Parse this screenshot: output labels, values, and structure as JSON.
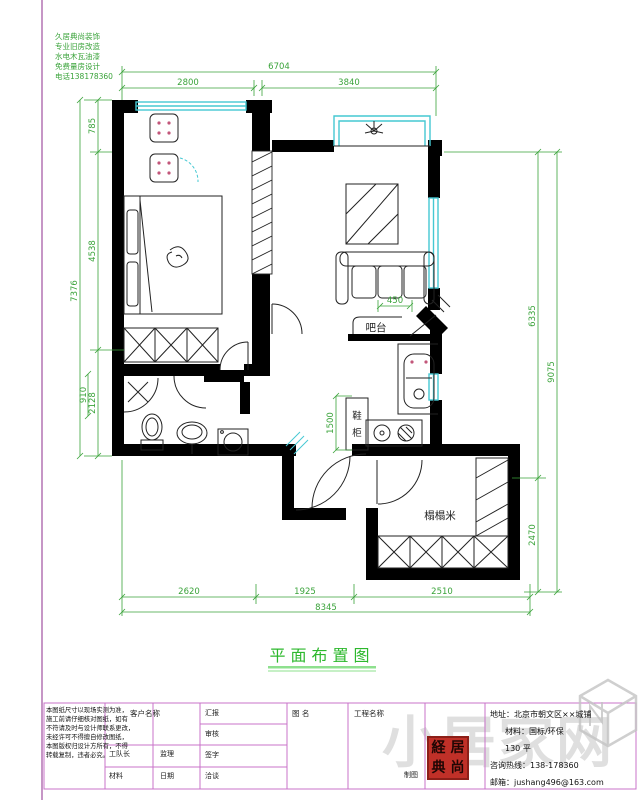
{
  "drawing": {
    "title": "平面布置图",
    "labels": {
      "bar": "吧台",
      "shoe_1": "鞋",
      "shoe_2": "柜",
      "tatami": "榻榻米"
    },
    "dims": {
      "top_total": "6704",
      "top_left": "2800",
      "top_right": "3840",
      "left_total": "7376",
      "left_top": "785",
      "left_mid": "4538",
      "left_bottom": "2128",
      "left_inner": "910",
      "right_upper": "6335",
      "right_lower": "2470",
      "right_total": "9075",
      "bottom_left": "2620",
      "bottom_mid": "1925",
      "bottom_right": "2510",
      "bottom_total": "8345",
      "shoe_height": "1500",
      "bar_width": "450"
    },
    "colors": {
      "dimension": "#3aa33a",
      "window": "#45c8d2",
      "wall": "#000000",
      "border": "#a050a0",
      "title_green": "#2db82d",
      "seal_red": "#c03028"
    }
  },
  "stamp": {
    "lines": "久居典尚装饰\n专业旧房改造\n水电木瓦油漆\n免费量房设计\n电话138178360"
  },
  "title_block": {
    "notes": "本图纸尺寸以现场实测为准，\n施工前请仔细核对图纸，如有\n不符请及时与设计师联系更改，\n未经许可不得擅自修改图纸，\n本图版权归设计方所有，不得\n转载复制，违者必究。",
    "client_label": "客户名称",
    "rows_a": [
      "工队长",
      "监理"
    ],
    "rows_b": [
      "材料",
      "日期"
    ],
    "col_rows": [
      "汇报",
      "审核",
      "签字",
      "洽谈"
    ],
    "drawing_name_label": "图 名",
    "project_label": "工程名称",
    "draft_label": "制图",
    "seal_chars": [
      "経",
      "居",
      "典",
      "尚"
    ],
    "contact": {
      "address": "地址：北京市朝文区××城铺",
      "material": "材料：国标/环保",
      "area": "130 平",
      "hotline": "咨询热线：138-178360",
      "email": "邮箱：jushang496@163.com"
    }
  },
  "watermark": {
    "text": "小居家网"
  }
}
